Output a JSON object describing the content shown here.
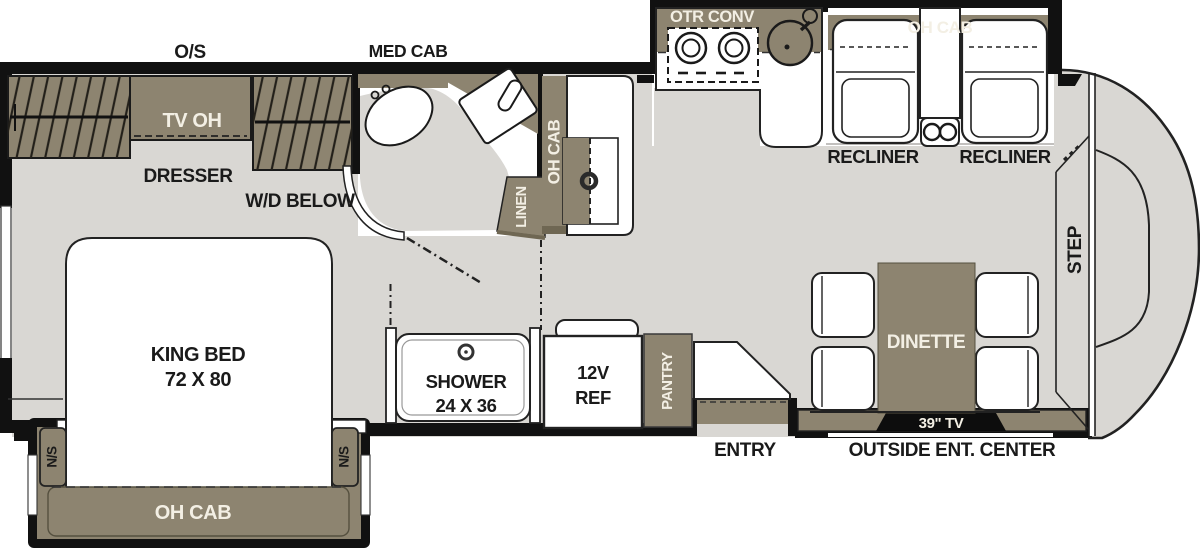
{
  "labels": {
    "outside_storage": "O/S",
    "med_cab": "MED CAB",
    "tv_oh": "TV OH",
    "dresser": "DRESSER",
    "wd_below": "W/D BELOW",
    "king_bed_line1": "KING BED",
    "king_bed_line2": "72 X 80",
    "nightstand_left": "N/S",
    "nightstand_right": "N/S",
    "bed_oh_cab": "OH CAB",
    "bath_oh_cab": "OH CAB",
    "linen": "LINEN",
    "shower_line1": "SHOWER",
    "shower_line2": "24 X 36",
    "fridge_line1": "12V",
    "fridge_line2": "REF",
    "pantry": "PANTRY",
    "entry": "ENTRY",
    "otr_conv": "OTR CONV",
    "living_oh_cab": "OH CAB",
    "recliner_left": "RECLINER",
    "recliner_right": "RECLINER",
    "dinette": "DINETTE",
    "tv_39": "39\" TV",
    "outside_ent_center": "OUTSIDE ENT. CENTER",
    "step": "STEP"
  },
  "colors": {
    "cabinet_tan": "#8d8470",
    "cabinet_tan_dark": "#6f6753",
    "floor_gray": "#d9d7d3",
    "wall_black": "#111111",
    "label_dark": "#1a1a1a",
    "label_light": "#f3efe4"
  }
}
